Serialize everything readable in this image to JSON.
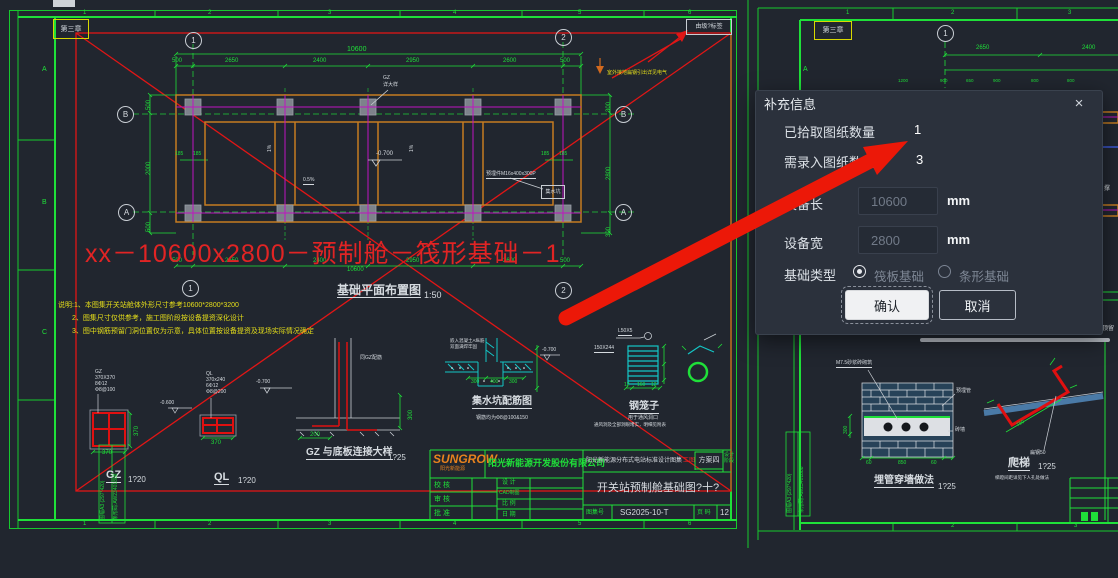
{
  "colors": {
    "canvas_bg": "#21262f",
    "cad_green": "#1fe039",
    "cad_red": "#e01616",
    "cad_orange": "#c67c20",
    "cad_magenta": "#c014c0",
    "cad_cyan": "#14c6c6",
    "note_yellow": "#e6df1a",
    "arrow_red": "#ec1808",
    "dialog_bg": "#2b313c"
  },
  "dialog": {
    "title": "补充信息",
    "close": "×",
    "picked_label": "已拾取图纸数量",
    "picked_value": "1",
    "need_label": "需录入图纸数量",
    "need_value": "3",
    "length_label": "设备长",
    "length_value": "10600",
    "width_label": "设备宽",
    "width_value": "2800",
    "unit": "mm",
    "type_label": "基础类型",
    "type_options": [
      "筏板基础",
      "条形基础"
    ],
    "confirm": "确认",
    "cancel": "取消"
  },
  "left_sheet": {
    "zone_tag": "第三章",
    "corner_tag": "由级?标签",
    "col_numbers": [
      "1",
      "2",
      "3",
      "4",
      "5",
      "6"
    ],
    "row_letters": [
      "A",
      "B",
      "C"
    ],
    "bubbles": [
      "1",
      "2",
      "A",
      "B"
    ],
    "plan": {
      "title": "基础平面布置图",
      "scale": "1:50",
      "overall_dim": "10600",
      "top_dims": [
        "500",
        "2650",
        "2400",
        "2950",
        "2600",
        "500"
      ],
      "bottom_dims": [
        "500",
        "2650",
        "2400",
        "2950",
        "2600",
        "500"
      ],
      "left_dims": [
        "500",
        "2000",
        "500"
      ],
      "right_dims": [
        "300",
        "2800",
        "300"
      ],
      "pair_dims": [
        "185",
        "185"
      ],
      "slope_a": "1%",
      "slope_b": "0.5%",
      "elev_center": "-0.700",
      "gz_label": "GZ",
      "gz_label2": "详大样",
      "ground_note": "室外接地扁钢引出详见电气",
      "embed_label": "预埋件M16x400x300P",
      "sump_box": "集水坑"
    },
    "red_overlay": "xx－10600x2800－预制舱－筏形基础－1",
    "notes": [
      "说明:1、本图集开关站舱体外形尺寸参考10600*2800*3200",
      "2、图集尺寸仅供参考，施工图阶段按设备提资深化设计",
      "3、图中钢筋预留门洞位置仅为示意，具体位置按设备提资及现场实际情况确定"
    ],
    "details": {
      "gz": {
        "labels": [
          "GZ",
          "370X370",
          "8Φ12",
          "Φ8@100"
        ],
        "dim": "370",
        "side_dim": "370",
        "caption": "GZ",
        "scale": "1?20"
      },
      "ql": {
        "labels": [
          "QL",
          "370x240",
          "6Φ12",
          "Φ8@200"
        ],
        "dim": "370",
        "caption": "QL",
        "scale": "1?20",
        "elev": "-0.600"
      },
      "gz_base": {
        "caption": "GZ 与底板连接大样",
        "scale": "1?25",
        "dim_w": "200",
        "dim_h": "300",
        "note": "同GZ配筋",
        "elev": "-0.700"
      },
      "sump": {
        "caption": "集水坑配筋图",
        "sub": "钢筋均为Φ8@100&150",
        "dims": [
          "300",
          "400",
          "300"
        ],
        "label1": "嵌入混凝土A纵筋",
        "label2": "双面满焊牢固",
        "elev": "-0.700"
      },
      "cage": {
        "caption": "钢笼子",
        "sub1": "用于通风洞口",
        "sub2": "通风洞及全部洞眼堵实，明细见附表",
        "label1": "L50X5",
        "label2": "150X244",
        "dims": [
          "12",
          "160",
          "12"
        ]
      }
    },
    "title_block": {
      "logo": "SUNGROW",
      "logo_sub": "阳光新能源",
      "company": "阳光新能源开发股份有限公司",
      "album": "阳光新能源分布式电站标准设计图集",
      "stage": "工图",
      "scheme": "方案四",
      "stage_col": "设计阶段",
      "drawing_title": "开关站预制舱基础图?十?",
      "rows_left": [
        "校 核",
        "审 核",
        "批 准"
      ],
      "rows_mid": [
        "设 计",
        "CAD制图",
        "比 例",
        "日 期"
      ],
      "catalog_label": "图集号",
      "catalog_no": "SG2025-10-T",
      "page_label": "页 码",
      "page_no": "12"
    },
    "side_text1": "图幅A3 (297*420)",
    "side_text2": "条形码:AW23401888"
  },
  "right_sheet": {
    "zone_tag": "第三章",
    "axis_top": "1",
    "row_letter": "A",
    "col_numbers": [
      "1",
      "2",
      "3"
    ],
    "dims": [
      "2650",
      "2400"
    ],
    "small_dims": [
      "1200",
      "900",
      "650",
      "900",
      "800",
      "800"
    ],
    "details": {
      "pipe_wall": {
        "caption": "埋管穿墙做法",
        "scale": "1?25",
        "note": "M7.5砂浆砖砌筑",
        "label_pipe": "预埋管",
        "label_wall": "砖墙",
        "dims": [
          "60",
          "850",
          "60"
        ],
        "dim_left": "300"
      },
      "ladder": {
        "caption": "爬梯",
        "scale": "1?25",
        "sub": "梯蹬间距详见下人孔处做法",
        "dim": "750",
        "label": "扁钢50"
      }
    },
    "bottom_numbers": [
      "2",
      "3"
    ],
    "side_text1": "图幅A3 (297*420)",
    "side_text2": "条形码:AW23401888",
    "edge_fragment": "顶留",
    "edge_fragment2": "撑"
  }
}
